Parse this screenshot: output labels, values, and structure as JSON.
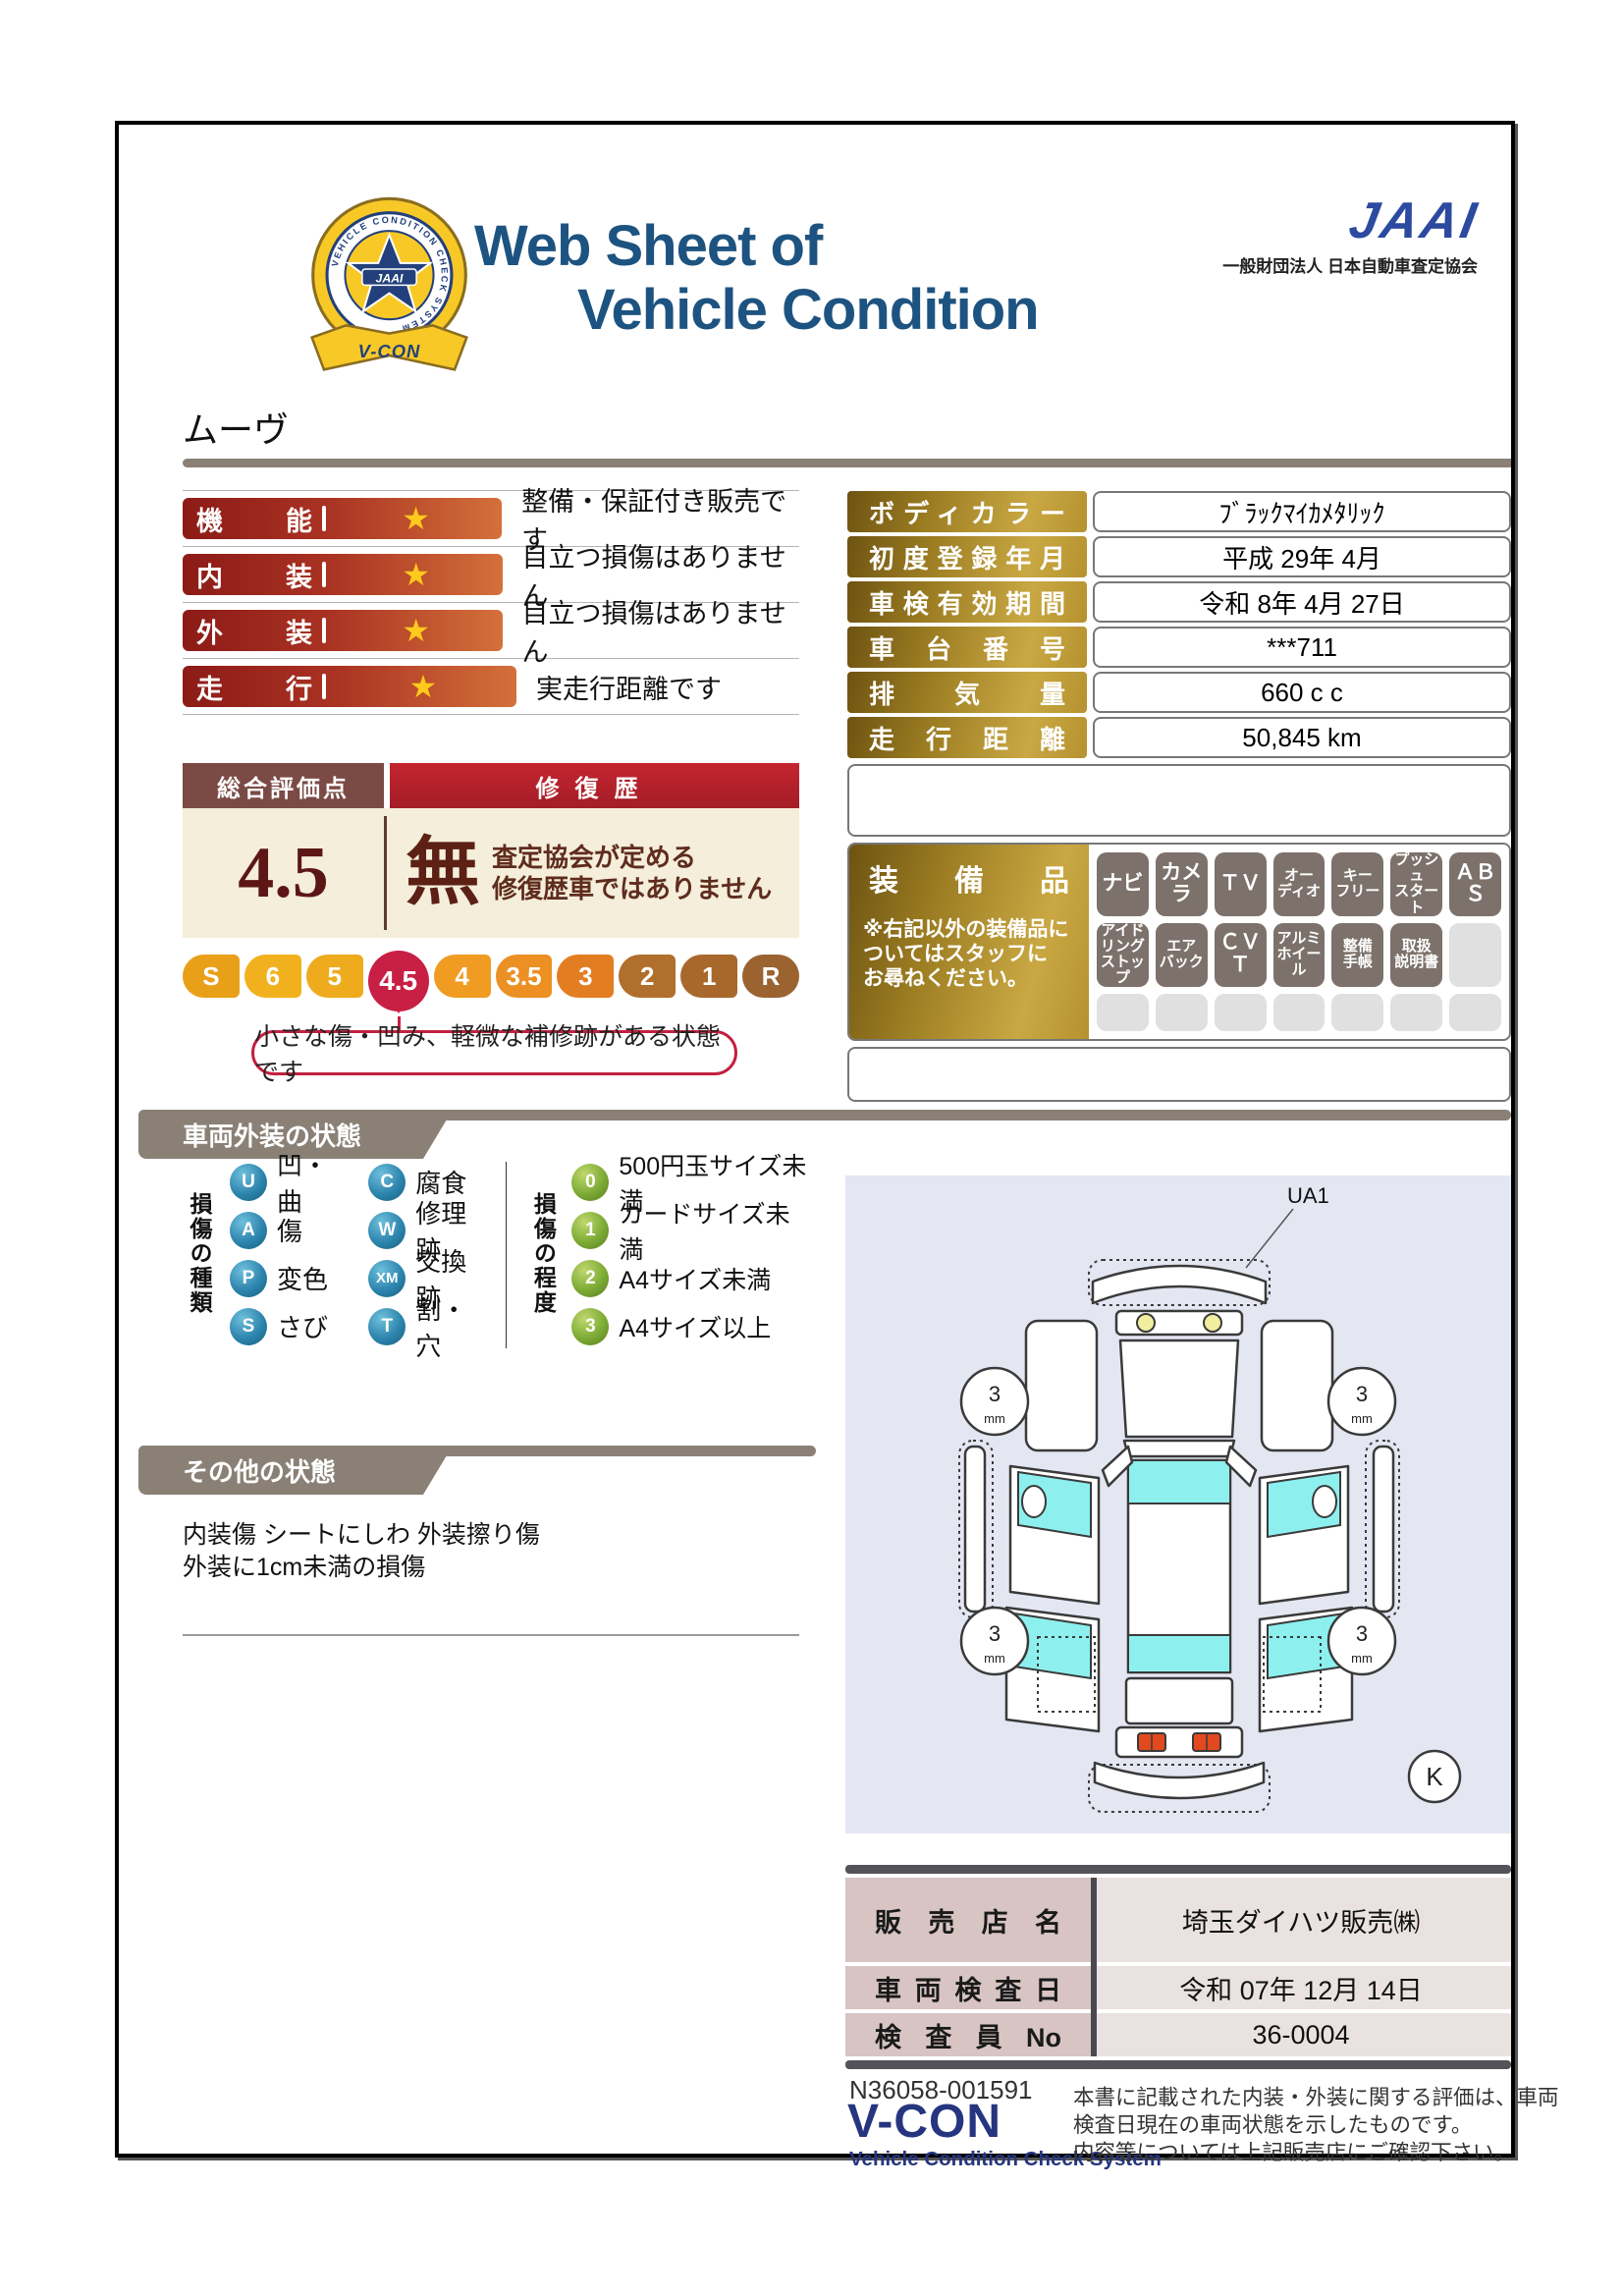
{
  "colors": {
    "title_blue": "#1d5380",
    "jaai_blue": "#2b4aa0",
    "bar_red_dark": "#8c1b17",
    "bar_red_light": "#d4703a",
    "gold_dark": "#6d5312",
    "gold_light": "#c9a843",
    "crimson": "#c81f45",
    "taupe_banner": "#8a8076",
    "cream": "#f4eeda",
    "navy_footer": "#26357f",
    "diagram_bg": "#e4e6f2"
  },
  "emblem": {
    "ring_text": "VEHICLE CONDITION CHECK SYSTEM",
    "star_label": "JAAI",
    "ribbon_label": "V-CON"
  },
  "header": {
    "title_line1": "Web Sheet of",
    "title_line2": "Vehicle Condition",
    "jaai_wordmark": "JAAI",
    "jaai_subtitle": "一般財団法人 日本自動車査定協会"
  },
  "vehicle_name": "ムーヴ",
  "star_icon": "★",
  "ratings": [
    {
      "label": "機能",
      "comment": "整備・保証付き販売です"
    },
    {
      "label": "内装",
      "comment": "目立つ損傷はありません"
    },
    {
      "label": "外装",
      "comment": "目立つ損傷はありません"
    },
    {
      "label": "走行",
      "comment": "実走行距離です"
    }
  ],
  "overall": {
    "header_left": "総合評価点",
    "header_right": "修復歴",
    "score": "4.5",
    "repair_value": "無",
    "repair_note": "査定協会が定める\n修復歴車ではありません",
    "scale": [
      "S",
      "6",
      "5",
      "4.5",
      "4",
      "3.5",
      "3",
      "2",
      "1",
      "R"
    ],
    "selected": "4.5",
    "callout": "小さな傷・凹み、軽微な補修跡がある状態です"
  },
  "specs": {
    "rows": [
      {
        "label": "ボディカラー",
        "value": "ﾌﾞﾗｯｸﾏｲｶﾒﾀﾘｯｸ"
      },
      {
        "label": "初度登録年月",
        "value": "平成 29年 4月"
      },
      {
        "label": "車検有効期間",
        "value": "令和 8年 4月 27日"
      },
      {
        "label": "車台番号",
        "value": "***711"
      },
      {
        "label": "排気量",
        "value": "660 c c"
      },
      {
        "label": "走行距離",
        "value": "50,845 km"
      }
    ]
  },
  "equipment": {
    "title": "装備品",
    "note": "※右記以外の装備品に\nついてはスタッフに\nお尋ねください。",
    "items": [
      {
        "label": "ナビ",
        "active": true
      },
      {
        "label": "カメラ",
        "active": true
      },
      {
        "label": "ＴＶ",
        "active": true
      },
      {
        "label": "オー\nディオ",
        "active": true
      },
      {
        "label": "キー\nフリー",
        "active": true
      },
      {
        "label": "プッシュ\nスタート",
        "active": true
      },
      {
        "label": "ＡＢＳ",
        "active": true
      },
      {
        "label": "アイド\nリング\nストップ",
        "active": true
      },
      {
        "label": "エア\nバック",
        "active": true
      },
      {
        "label": "ＣＶＴ",
        "active": true
      },
      {
        "label": "アルミ\nホイール",
        "active": true
      },
      {
        "label": "整備\n手帳",
        "active": true
      },
      {
        "label": "取扱\n説明書",
        "active": true
      },
      {
        "label": "",
        "active": false
      },
      {
        "label": "",
        "active": false
      },
      {
        "label": "",
        "active": false
      },
      {
        "label": "",
        "active": false
      },
      {
        "label": "",
        "active": false
      },
      {
        "label": "",
        "active": false
      },
      {
        "label": "",
        "active": false
      },
      {
        "label": "",
        "active": false
      }
    ]
  },
  "exterior": {
    "banner": "車両外装の状態",
    "type_title": "損傷の種類",
    "types": [
      {
        "code": "U",
        "label": "凹・曲"
      },
      {
        "code": "C",
        "label": "腐食"
      },
      {
        "code": "A",
        "label": "傷"
      },
      {
        "code": "W",
        "label": "修理跡"
      },
      {
        "code": "P",
        "label": "変色"
      },
      {
        "code": "XM",
        "label": "交換跡"
      },
      {
        "code": "S",
        "label": "さび"
      },
      {
        "code": "T",
        "label": "割・穴"
      }
    ],
    "grade_title": "損傷の程度",
    "grades": [
      {
        "code": "0",
        "label": "500円玉サイズ未満"
      },
      {
        "code": "1",
        "label": "カードサイズ未満"
      },
      {
        "code": "2",
        "label": "A4サイズ未満"
      },
      {
        "code": "3",
        "label": "A4サイズ以上"
      }
    ]
  },
  "other": {
    "banner": "その他の状態",
    "text": "内装傷 シートにしわ 外装擦り傷\n外装に1cm未満の損傷"
  },
  "diagram": {
    "part_code": "UA1",
    "tire_value": "3",
    "tire_unit": "mm",
    "key_label": "K"
  },
  "dealer": {
    "rows": [
      {
        "label": "販売店名",
        "value": "埼玉ダイハツ販売㈱"
      },
      {
        "label": "車両検査日",
        "value": "令和 07年 12月 14日"
      },
      {
        "label": "検査員No",
        "value": "36-0004"
      }
    ]
  },
  "footer": {
    "doc_number": "N36058-001591",
    "brand": "V-CON",
    "brand_sub": "Vehicle Condition Check System",
    "note": "本書に記載された内装・外装に関する評価は、車両\n検査日現在の車両状態を示したものです。\n内容等については上記販売店にご確認下さい。"
  }
}
